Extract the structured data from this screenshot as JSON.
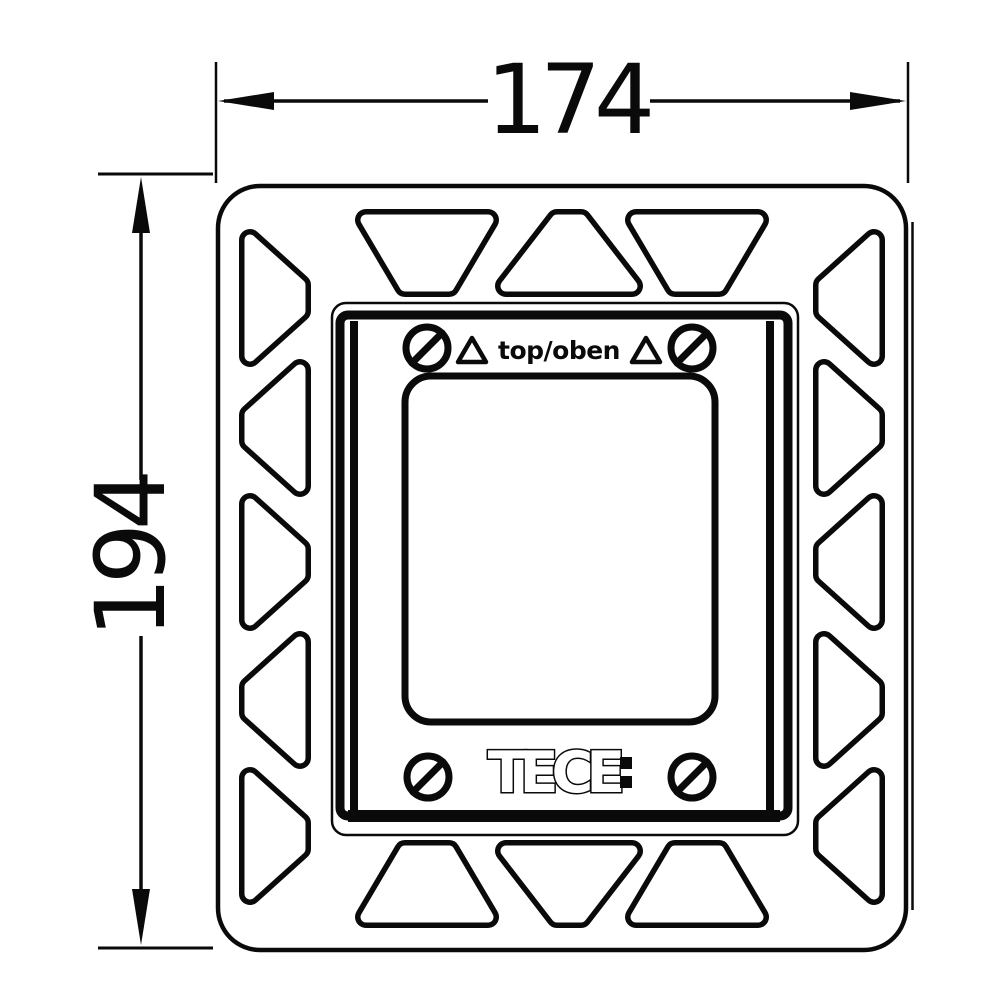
{
  "dimensions": {
    "width": "174",
    "height": "194"
  },
  "markings": {
    "orientation": "top/oben",
    "brand": "TECE",
    "brand_suffix": ":"
  },
  "colors": {
    "line": "#0a0a0a",
    "background": "#ffffff"
  },
  "geometry": {
    "screw_radius": 21,
    "screws": [
      {
        "id": "screw-top-left",
        "cx": 427,
        "cy": 348
      },
      {
        "id": "screw-top-right",
        "cx": 692,
        "cy": 348
      },
      {
        "id": "screw-bottom-left",
        "cx": 428,
        "cy": 777
      },
      {
        "id": "screw-bottom-right",
        "cx": 692,
        "cy": 777
      }
    ],
    "orientation_triangles": [
      {
        "id": "triangle-left",
        "cx": 472,
        "cy": 351
      },
      {
        "id": "triangle-right",
        "cx": 646,
        "cy": 351
      }
    ],
    "cutouts": [
      {
        "id": "top-1",
        "points": [
          [
            366,
            220
          ],
          [
            488,
            220
          ],
          [
            449,
            286
          ],
          [
            405,
            286
          ]
        ]
      },
      {
        "id": "top-2",
        "points": [
          [
            557,
            220
          ],
          [
            581,
            220
          ],
          [
            632,
            286
          ],
          [
            506,
            286
          ]
        ]
      },
      {
        "id": "top-3",
        "points": [
          [
            636,
            220
          ],
          [
            758,
            220
          ],
          [
            719,
            286
          ],
          [
            675,
            286
          ]
        ]
      },
      {
        "id": "bottom-1",
        "points": [
          [
            405,
            851
          ],
          [
            449,
            851
          ],
          [
            488,
            917
          ],
          [
            366,
            917
          ]
        ]
      },
      {
        "id": "bottom-2",
        "points": [
          [
            506,
            851
          ],
          [
            632,
            851
          ],
          [
            581,
            917
          ],
          [
            557,
            917
          ]
        ]
      },
      {
        "id": "bottom-3",
        "points": [
          [
            675,
            851
          ],
          [
            719,
            851
          ],
          [
            758,
            917
          ],
          [
            636,
            917
          ]
        ]
      },
      {
        "id": "left-1",
        "points": [
          [
            250,
            240
          ],
          [
            300,
            285
          ],
          [
            300,
            311
          ],
          [
            250,
            356
          ]
        ]
      },
      {
        "id": "left-2",
        "points": [
          [
            300,
            370
          ],
          [
            300,
            486
          ],
          [
            250,
            441
          ],
          [
            250,
            415
          ]
        ]
      },
      {
        "id": "left-3",
        "points": [
          [
            250,
            504
          ],
          [
            300,
            549
          ],
          [
            300,
            575
          ],
          [
            250,
            620
          ]
        ]
      },
      {
        "id": "left-4",
        "points": [
          [
            300,
            642
          ],
          [
            300,
            758
          ],
          [
            250,
            713
          ],
          [
            250,
            687
          ]
        ]
      },
      {
        "id": "left-5",
        "points": [
          [
            250,
            778
          ],
          [
            300,
            823
          ],
          [
            300,
            849
          ],
          [
            250,
            894
          ]
        ]
      },
      {
        "id": "right-1",
        "points": [
          [
            874,
            240
          ],
          [
            824,
            285
          ],
          [
            824,
            311
          ],
          [
            874,
            356
          ]
        ]
      },
      {
        "id": "right-2",
        "points": [
          [
            824,
            370
          ],
          [
            824,
            486
          ],
          [
            874,
            441
          ],
          [
            874,
            415
          ]
        ]
      },
      {
        "id": "right-3",
        "points": [
          [
            874,
            504
          ],
          [
            824,
            549
          ],
          [
            824,
            575
          ],
          [
            874,
            620
          ]
        ]
      },
      {
        "id": "right-4",
        "points": [
          [
            824,
            642
          ],
          [
            824,
            758
          ],
          [
            874,
            713
          ],
          [
            874,
            687
          ]
        ]
      },
      {
        "id": "right-5",
        "points": [
          [
            874,
            778
          ],
          [
            824,
            823
          ],
          [
            824,
            849
          ],
          [
            874,
            894
          ]
        ]
      }
    ]
  }
}
